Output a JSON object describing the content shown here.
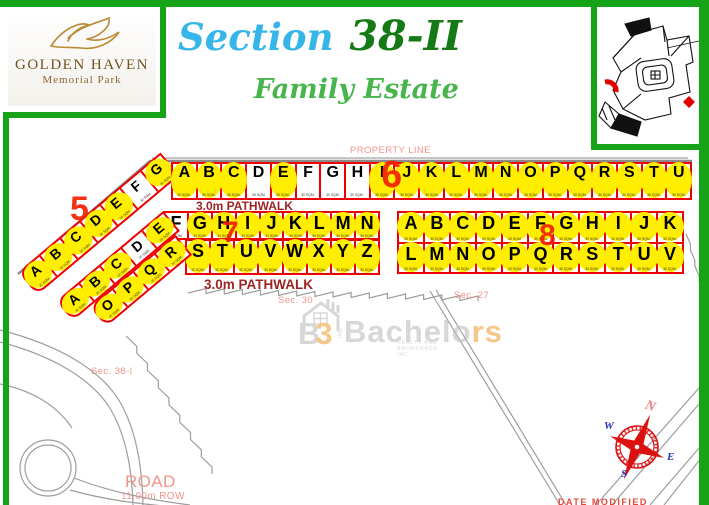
{
  "logo": {
    "line1": "GOLDEN HAVEN",
    "line2": "Memorial Park"
  },
  "title": {
    "section_word": "Section",
    "section_num": "38-II",
    "subtitle": "Family Estate"
  },
  "labels": {
    "property_line": "PROPERTY LINE",
    "pathwalk1": "3.0m PATHWALK",
    "pathwalk2": "3.0m PATHWALK",
    "sec30": "Sec. 30",
    "sec27": "Sec. 27",
    "sec38i": "Sec. 38-I",
    "road": "ROAD",
    "road_row": "11.00m ROW",
    "footer": "DATE MODIFIED"
  },
  "sqm_label": "30 SQM.",
  "compass": {
    "n": "N",
    "e": "E",
    "s": "S",
    "w": "W"
  },
  "watermark": {
    "b": "B",
    "three": "3",
    "inc": "INC",
    "name_gray": "Bachelo",
    "name_orange": "rs",
    "tagline": "REALTY AND BROKERAGE INC"
  },
  "plots": {
    "sec5": {
      "number": "5",
      "rows": [
        {
          "letters": "ABCDEFG",
          "hl": [
            1,
            1,
            1,
            1,
            1,
            0,
            1
          ]
        }
      ]
    },
    "sec6": {
      "number": "6",
      "rows": [
        {
          "letters": "ABCDEFGHIJKLMNOPQRSTU",
          "hl": [
            1,
            1,
            1,
            0,
            1,
            0,
            0,
            0,
            1,
            1,
            1,
            1,
            1,
            1,
            1,
            1,
            1,
            1,
            1,
            1,
            1
          ]
        }
      ]
    },
    "sec7": {
      "number": "7",
      "rows": [
        {
          "letters": "FGHIJKLMN",
          "hl": [
            0,
            1,
            1,
            1,
            1,
            1,
            1,
            1,
            1
          ]
        },
        {
          "letters": "STUVWXYZ",
          "hl": [
            1,
            1,
            1,
            1,
            1,
            1,
            1,
            1
          ]
        },
        {
          "letters": "ABCDE",
          "hl": [
            1,
            1,
            1,
            0,
            1
          ]
        },
        {
          "letters": "OPQR",
          "hl": [
            1,
            1,
            1,
            1
          ]
        }
      ]
    },
    "sec8": {
      "number": "8",
      "rows": [
        {
          "letters": "ABCDEFGHIJK",
          "hl": [
            1,
            1,
            1,
            1,
            1,
            1,
            1,
            1,
            1,
            1,
            1
          ]
        },
        {
          "letters": "LMNOPQRSTUV",
          "hl": [
            1,
            1,
            1,
            1,
            1,
            1,
            1,
            1,
            1,
            1,
            1
          ]
        }
      ]
    }
  },
  "colors": {
    "frame_green": "#17a317",
    "plot_red": "#ee0000",
    "highlight_yellow": "#ffee00",
    "label_salmon": "#f0958b",
    "pathwalk_maroon": "#9c2424",
    "section_number_red": "#f32000",
    "title_cyan": "#36b5e8",
    "title_green": "#157a15",
    "subtitle_green": "#47b54b"
  }
}
